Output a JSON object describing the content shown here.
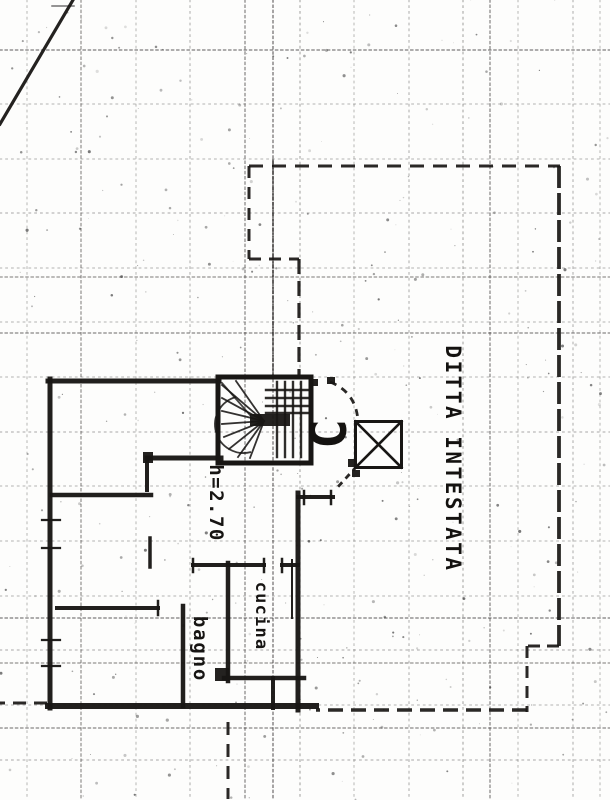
{
  "document": {
    "type": "scanned cadastral floor plan",
    "language": "it"
  },
  "colors": {
    "paper": "#fdfdfc",
    "ink": "#181614",
    "grid": "#3d3a38"
  },
  "plan": {
    "labels": [
      {
        "name": "label-ditta-intestata",
        "text": "DITTA INTESTATA",
        "x": 453,
        "y": 459,
        "rotate": 90,
        "size": 21,
        "spacing": 2.5,
        "class": "lbl-big"
      },
      {
        "name": "label-height-note",
        "text": "h=2.70",
        "x": 216,
        "y": 503,
        "rotate": 90,
        "size": 19,
        "spacing": 1.5,
        "class": "lbl"
      },
      {
        "name": "label-room-cucina",
        "text": "cucina",
        "x": 261,
        "y": 616,
        "rotate": 90,
        "size": 17,
        "spacing": 1.2,
        "class": "lbl"
      },
      {
        "name": "label-room-bagno",
        "text": "bagno",
        "x": 200,
        "y": 649,
        "rotate": 90,
        "size": 19,
        "spacing": 1.8,
        "class": "lbl"
      },
      {
        "name": "label-letter-c",
        "text": "C",
        "x": 329,
        "y": 434,
        "rotate": -90,
        "size": 50,
        "spacing": 0,
        "class": "lbl-big"
      }
    ],
    "walls": [
      [
        48,
        381,
        219,
        381,
        5
      ],
      [
        50,
        379,
        50,
        708,
        5
      ],
      [
        48,
        706,
        316,
        706,
        6
      ],
      [
        147,
        458,
        221,
        458,
        5
      ],
      [
        147,
        458,
        147,
        490,
        4
      ],
      [
        52,
        495,
        151,
        495,
        4.5
      ],
      [
        150,
        538,
        150,
        567,
        3.5
      ],
      [
        57,
        608,
        158,
        608,
        4
      ],
      [
        158,
        601,
        158,
        615,
        2.5
      ],
      [
        183,
        606,
        183,
        706,
        4.5
      ],
      [
        228,
        563,
        228,
        681,
        4.5
      ],
      [
        224,
        678,
        304,
        678,
        4.5
      ],
      [
        273,
        678,
        273,
        708,
        4
      ],
      [
        298,
        493,
        298,
        710,
        5
      ],
      [
        292,
        560,
        292,
        618,
        2
      ],
      [
        298,
        497,
        333,
        497,
        4
      ],
      [
        304,
        491,
        304,
        504,
        2.5
      ],
      [
        331,
        491,
        331,
        504,
        2.5
      ],
      [
        193,
        565,
        264,
        565,
        4
      ],
      [
        282,
        565,
        298,
        565,
        4
      ],
      [
        264,
        559,
        264,
        572,
        2.5
      ],
      [
        282,
        559,
        282,
        572,
        2.5
      ],
      [
        193,
        559,
        193,
        572,
        2.5
      ],
      [
        42,
        520,
        60,
        520,
        2.2
      ],
      [
        42,
        548,
        60,
        548,
        2.2
      ],
      [
        42,
        640,
        60,
        640,
        2.2
      ],
      [
        42,
        666,
        60,
        666,
        2.2
      ]
    ],
    "boundary_dashed": [
      [
        249,
        166,
        560,
        166,
        3,
        "14 9"
      ],
      [
        249,
        166,
        249,
        259,
        3,
        "12 9"
      ],
      [
        249,
        259,
        299,
        259,
        3,
        "12 8"
      ],
      [
        299,
        259,
        299,
        379,
        3.2,
        "15 7"
      ],
      [
        559,
        166,
        559,
        646,
        3.8,
        "22 5"
      ],
      [
        559,
        646,
        527,
        646,
        3,
        "12 7"
      ],
      [
        527,
        646,
        527,
        712,
        3,
        "12 8"
      ],
      [
        527,
        710,
        316,
        710,
        3.4,
        "15 8"
      ],
      [
        47,
        703,
        0,
        703,
        3,
        "13 8"
      ],
      [
        228,
        722,
        228,
        799,
        3,
        "13 9"
      ]
    ],
    "thin_lines": [
      [
        0,
        124,
        73,
        0,
        3.2
      ],
      [
        273,
        160,
        273,
        379,
        1.4
      ],
      [
        52,
        6,
        74,
        6,
        1.5
      ]
    ],
    "stair": {
      "box": [
        218,
        377,
        93,
        86
      ],
      "border": 5,
      "center": [
        264,
        421
      ],
      "center_bar": [
        250,
        414,
        40,
        12
      ],
      "fan_tips": [
        [
          222,
          385
        ],
        [
          222,
          398
        ],
        [
          222,
          411
        ],
        [
          222,
          424
        ],
        [
          224,
          437
        ],
        [
          229,
          449
        ],
        [
          238,
          457
        ],
        [
          250,
          458
        ],
        [
          236,
          381
        ]
      ],
      "treads_v": {
        "xs": [
          277,
          285,
          293,
          301
        ],
        "y1": 382,
        "y2": 457
      },
      "treads_h": {
        "ys": [
          390,
          398,
          406,
          413
        ],
        "x1": 266,
        "x2": 309
      },
      "arc": "M 251 452 A 27 27 0 0 1 236 397",
      "diag": [
        222,
        383,
        250,
        415
      ]
    },
    "xbox": {
      "rect": [
        355.5,
        421.5,
        46,
        46
      ],
      "stroke": 3,
      "diag_stroke": 2.6
    },
    "dashed_arcs": [
      {
        "d": "M 330 382 Q 356 392 358 421",
        "w": 2.8,
        "dash": "7 6"
      },
      {
        "d": "M 357 466 L 336 489",
        "w": 2.8,
        "dash": "6 5"
      }
    ],
    "ink_dots": [
      [
        310,
        379,
        8,
        7
      ],
      [
        327,
        377,
        8,
        7
      ],
      [
        348,
        459,
        9,
        8
      ],
      [
        352,
        470,
        8,
        7
      ],
      [
        215,
        668,
        14,
        13
      ],
      [
        143,
        452,
        10,
        11
      ]
    ],
    "grid_rows": [
      [
        50,
        0.55
      ],
      [
        104,
        0.3
      ],
      [
        159,
        0.3
      ],
      [
        213,
        0.35
      ],
      [
        268,
        0.3
      ],
      [
        277,
        0.45
      ],
      [
        322,
        0.3
      ],
      [
        333,
        0.5
      ],
      [
        377,
        0.3
      ],
      [
        432,
        0.35
      ],
      [
        486,
        0.3
      ],
      [
        541,
        0.3
      ],
      [
        596,
        0.3
      ],
      [
        618,
        0.55
      ],
      [
        650,
        0.35
      ],
      [
        663,
        0.45
      ],
      [
        705,
        0.3
      ],
      [
        728,
        0.5
      ],
      [
        760,
        0.35
      ]
    ],
    "grid_cols": [
      [
        27,
        0.3
      ],
      [
        81,
        0.45
      ],
      [
        136,
        0.3
      ],
      [
        190,
        0.35
      ],
      [
        245,
        0.5
      ],
      [
        273,
        0.6
      ],
      [
        300,
        0.4
      ],
      [
        354,
        0.3
      ],
      [
        409,
        0.35
      ],
      [
        463,
        0.4
      ],
      [
        490,
        0.5
      ],
      [
        518,
        0.3
      ],
      [
        573,
        0.35
      ],
      [
        600,
        0.3
      ]
    ]
  }
}
